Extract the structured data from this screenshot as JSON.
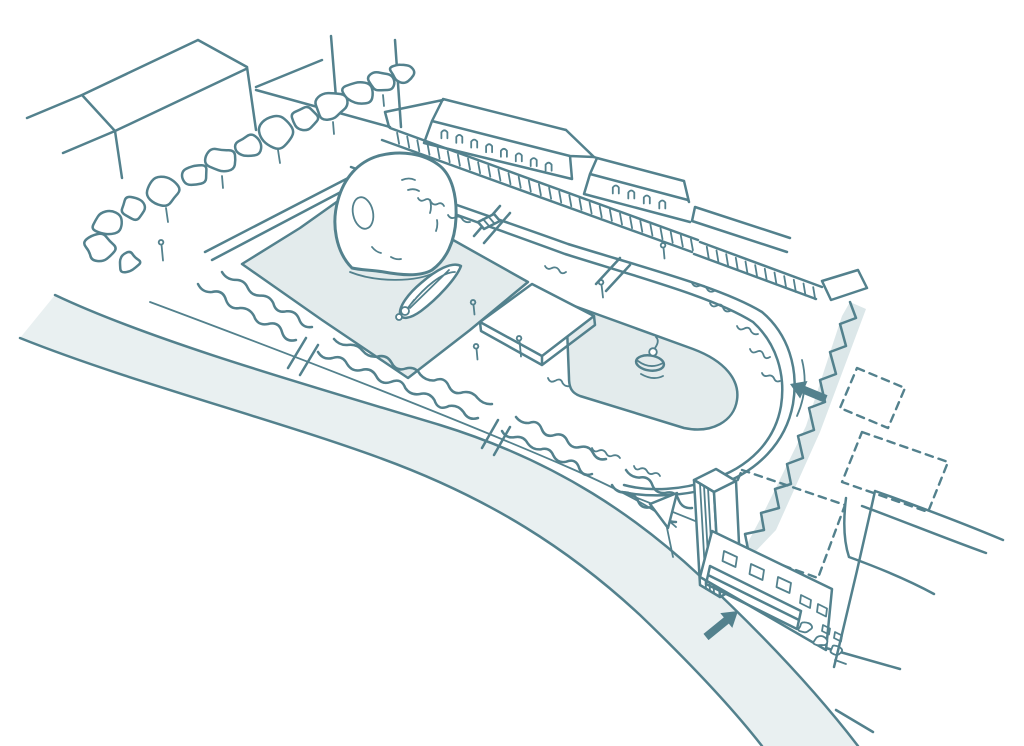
{
  "scene": {
    "type": "hand-drawn axonometric site plan sketch",
    "palette": {
      "ink": "#53818D",
      "water": "#E3EBEC",
      "road": "#E9F0F1",
      "shadow": "#DCE7E9",
      "paper": "#FFFFFF"
    },
    "features": {
      "buildings": [
        "northwest-building",
        "terrace-row",
        "colonnade",
        "clock-tower",
        "station-building"
      ],
      "water_bodies": [
        "rectangular-pond",
        "rounded-pond"
      ],
      "planting": [
        "tree-row",
        "hedge-row",
        "shrubs"
      ],
      "objects": [
        "shell-dome-pavilion",
        "boat",
        "stage-platform",
        "fountain",
        "footbridge",
        "sign-flag"
      ],
      "circulation": [
        "riverside-road",
        "curved-promenade",
        "crossing-paths",
        "street-junction",
        "plaza"
      ],
      "annotations": [
        "entry-arrow-plaza",
        "entry-arrow-road",
        "proposed-buildings-dashed"
      ]
    },
    "arrows": [
      {
        "id": "entry-arrow-plaza",
        "direction": "up-left",
        "style": "solid-filled"
      },
      {
        "id": "entry-arrow-road",
        "direction": "up-right",
        "style": "solid-filled"
      }
    ]
  }
}
